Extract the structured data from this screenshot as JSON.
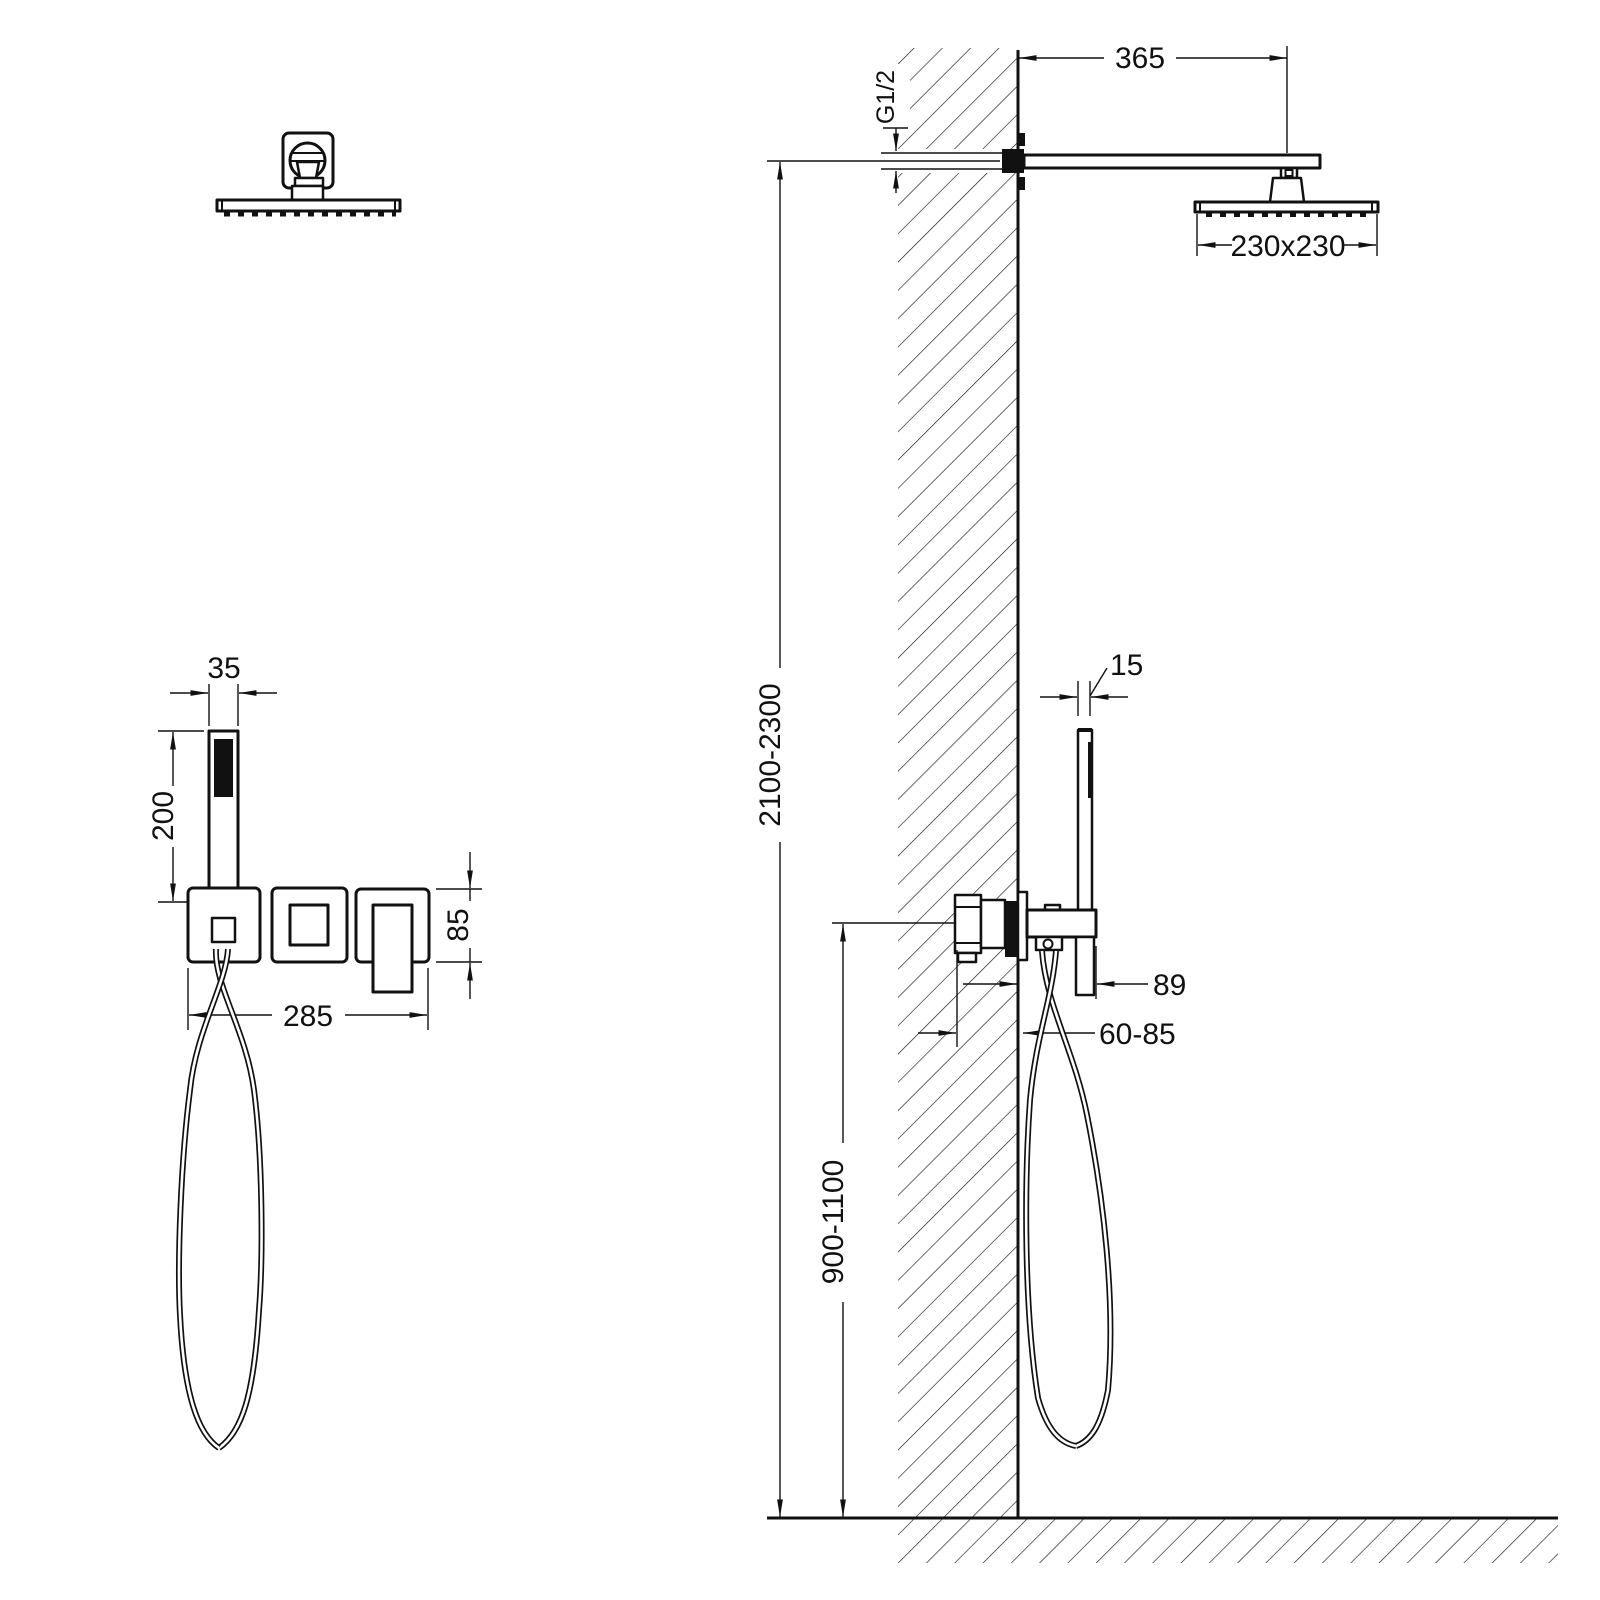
{
  "drawing": {
    "title_semantic": "concealed-shower-system-installation-dimensions",
    "colors": {
      "line": "#111111",
      "background": "#ffffff"
    },
    "front_view": {
      "dim_handset_width": "35",
      "dim_handset_length": "200",
      "dim_plate_height": "85",
      "dim_plate_width": "285"
    },
    "side_view": {
      "dim_arm_length": "365",
      "thread_label": "G1/2",
      "dim_head_size": "230x230",
      "dim_handset_depth": "15",
      "dim_overall_height": "2100-2300",
      "dim_body_projection": "89",
      "dim_embed_depth": "60-85",
      "dim_mixer_height": "900-1100"
    }
  }
}
